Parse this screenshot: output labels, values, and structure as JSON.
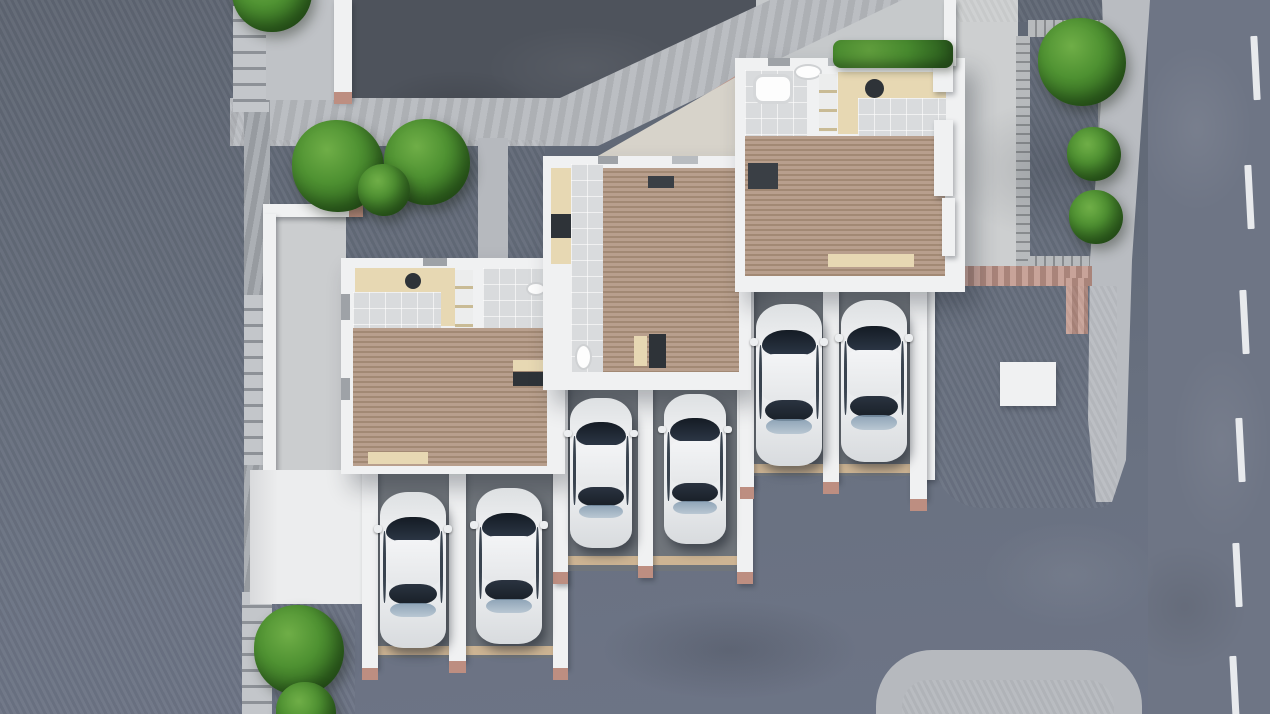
{
  "meta": {
    "scene": "aerial-3d-architectural-render",
    "description": "Top-down 3D architectural rendering of three staggered terraced houses with exposed interiors (wood decks, beige kitchens, bathrooms), three double carports with six white cars, green lawns with round trees, stone paths with steps, a dark driveway, and a street with a dashed white lane marking on the right"
  },
  "counts": {
    "houses": 3,
    "carport_bays": 6,
    "cars": 6,
    "trees": 9,
    "lane_dashes": 6
  },
  "palette": {
    "lawn": "#8fb322",
    "lawn_light": "#9fc02d",
    "road": "#667080",
    "street": "#6e7585",
    "driveway_dark": "#4e535c",
    "sidewalk": "#b6b9be",
    "concrete": "#cbcdcf",
    "forecourt_beige": "#d7d3ca",
    "carport_floor": "#70757b",
    "wall_white": "#f0f1f2",
    "wood_light": "#b89f8d",
    "wood_dark": "#a28974",
    "tile": "#d9dbdd",
    "kitchen_beige": "#e7d8b3",
    "accent_dark": "#2e3338",
    "brick_pink": "#c0968b",
    "threshold_tan": "#cdb493",
    "plank_gray": "#a7abae",
    "tree_green": "#4f9232",
    "car_body": "#eceef0",
    "car_glass": "#1d2530",
    "car_glass_blue": "#849cb2",
    "lane_marking": "#eef0f2"
  },
  "cars": [
    {
      "x": 380,
      "y": 492,
      "w": 66,
      "h": 156
    },
    {
      "x": 476,
      "y": 488,
      "w": 66,
      "h": 156
    },
    {
      "x": 570,
      "y": 398,
      "w": 62,
      "h": 150
    },
    {
      "x": 664,
      "y": 394,
      "w": 62,
      "h": 150
    },
    {
      "x": 756,
      "y": 304,
      "w": 66,
      "h": 162
    },
    {
      "x": 841,
      "y": 300,
      "w": 66,
      "h": 162
    }
  ],
  "trees": [
    {
      "cx": 272,
      "cy": -8,
      "r": 40
    },
    {
      "cx": 338,
      "cy": 166,
      "r": 46
    },
    {
      "cx": 427,
      "cy": 162,
      "r": 43
    },
    {
      "cx": 384,
      "cy": 190,
      "r": 26
    },
    {
      "cx": 1082,
      "cy": 62,
      "r": 44
    },
    {
      "cx": 1094,
      "cy": 154,
      "r": 27
    },
    {
      "cx": 1096,
      "cy": 217,
      "r": 27
    },
    {
      "cx": 299,
      "cy": 650,
      "r": 45
    },
    {
      "cx": 306,
      "cy": 712,
      "r": 30
    }
  ],
  "lane_dashes": [
    {
      "x": 1252,
      "y": 36
    },
    {
      "x": 1246,
      "y": 165
    },
    {
      "x": 1241,
      "y": 290
    },
    {
      "x": 1237,
      "y": 418
    },
    {
      "x": 1234,
      "y": 543
    },
    {
      "x": 1231,
      "y": 656
    }
  ]
}
